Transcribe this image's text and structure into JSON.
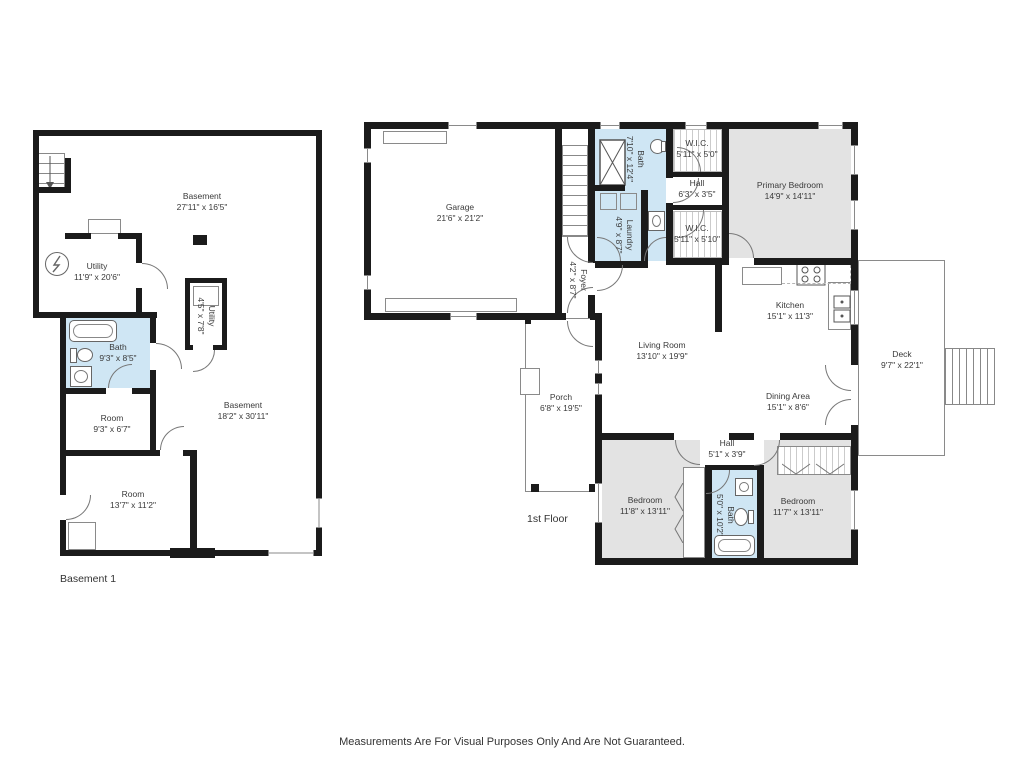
{
  "page": {
    "footer_disclaimer": "Measurements Are For Visual Purposes Only And Are Not Guaranteed."
  },
  "colors": {
    "wall": "#1b1b1b",
    "wet_room_fill": "#cfe6f4",
    "bedroom_fill": "#e3e3e3",
    "line": "#8a8a8a"
  },
  "plans": [
    {
      "title": "Basement 1",
      "rooms": {
        "basement_upper": {
          "name": "Basement",
          "dims": "27'11\" x 16'5\""
        },
        "utility": {
          "name": "Utility",
          "dims": "11'9\" x 20'6\""
        },
        "utility_closet": {
          "name": "Utility",
          "dims": "4'5\" x 7'8\""
        },
        "bath": {
          "name": "Bath",
          "dims": "9'3\" x 8'5\""
        },
        "room_small": {
          "name": "Room",
          "dims": "9'3\" x 6'7\""
        },
        "basement_lower": {
          "name": "Basement",
          "dims": "18'2\" x 30'11\""
        },
        "room_large": {
          "name": "Room",
          "dims": "13'7\" x 11'2\""
        }
      }
    },
    {
      "title": "1st Floor",
      "rooms": {
        "garage": {
          "name": "Garage",
          "dims": "21'6\" x 21'2\""
        },
        "bath_upper": {
          "name": "Bath",
          "dims": "7'10\" x 12'4\""
        },
        "laundry": {
          "name": "Laundry",
          "dims": "4'9\" x 8'7\""
        },
        "foyer": {
          "name": "Foyer",
          "dims": "4'2\" x 8'7\""
        },
        "wic_top": {
          "name": "W.I.C.",
          "dims": "5'11\" x 5'0\""
        },
        "hall_upper": {
          "name": "Hall",
          "dims": "6'3\" x 3'5\""
        },
        "wic_bottom": {
          "name": "W.I.C.",
          "dims": "5'11\" x 5'10\""
        },
        "primary_bedroom": {
          "name": "Primary Bedroom",
          "dims": "14'9\" x 14'11\""
        },
        "kitchen": {
          "name": "Kitchen",
          "dims": "15'1\" x 11'3\""
        },
        "living_room": {
          "name": "Living Room",
          "dims": "13'10\" x 19'9\""
        },
        "dining_area": {
          "name": "Dining Area",
          "dims": "15'1\" x 8'6\""
        },
        "deck": {
          "name": "Deck",
          "dims": "9'7\" x 22'1\""
        },
        "porch": {
          "name": "Porch",
          "dims": "6'8\" x 19'5\""
        },
        "hall_lower": {
          "name": "Hall",
          "dims": "5'1\" x 3'9\""
        },
        "bedroom_left": {
          "name": "Bedroom",
          "dims": "11'8\" x 13'11\""
        },
        "bath_lower": {
          "name": "Bath",
          "dims": "5'0\" x 10'2\""
        },
        "bedroom_right": {
          "name": "Bedroom",
          "dims": "11'7\" x 13'11\""
        }
      }
    }
  ]
}
